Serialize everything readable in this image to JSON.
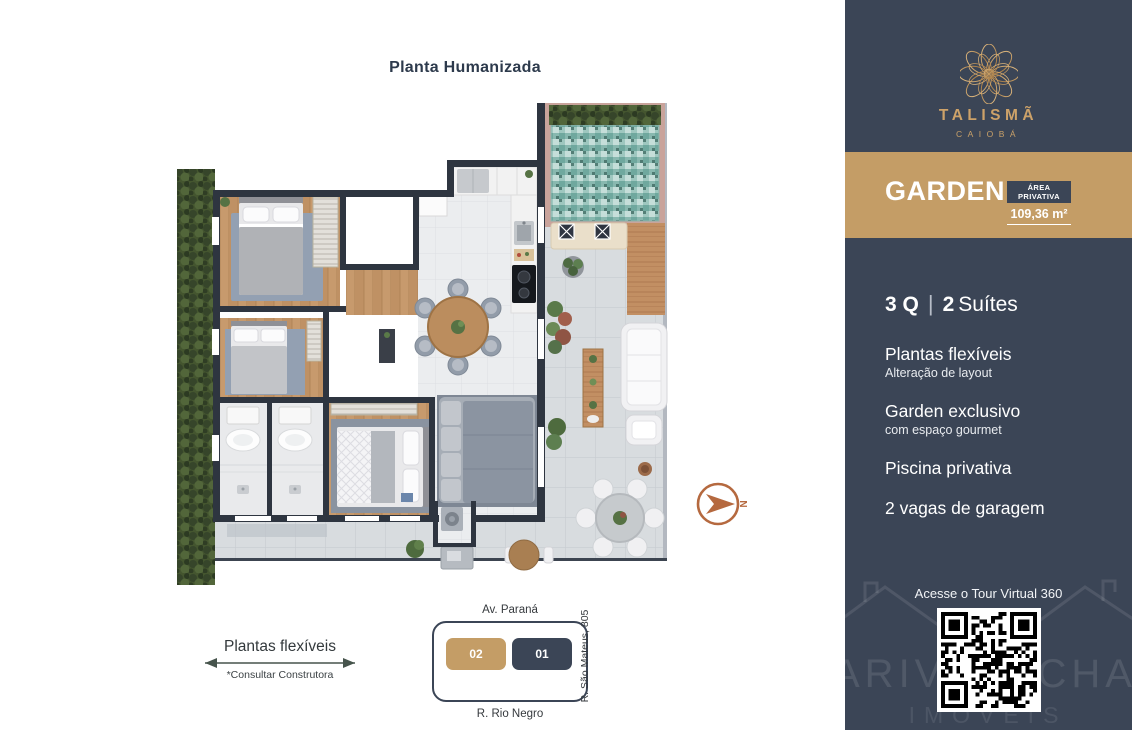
{
  "page": {
    "title": "Planta Humanizada"
  },
  "compass": {
    "north": "N"
  },
  "flex_note": {
    "label": "Plantas flexíveis",
    "note": "*Consultar Construtora"
  },
  "location": {
    "street_top": "Av. Paraná",
    "street_bottom": "R. Rio Negro",
    "street_right": "R. São Mateus, 805",
    "unit_left": "02",
    "unit_right": "01"
  },
  "sidebar": {
    "brand": {
      "name": "TALISMÃ",
      "city": "CAIOBÁ"
    },
    "banner": {
      "title": "GARDEN",
      "area_label": "ÁREA PRIVATIVA",
      "area_value": "109,36 m²"
    },
    "specs": {
      "rooms": {
        "q": "3 Q",
        "sep": "|",
        "suites_count": "2",
        "suites_label": "Suítes"
      },
      "items": [
        {
          "title": "Plantas flexíveis",
          "subtitle": "Alteração de layout"
        },
        {
          "title": "Garden exclusivo",
          "subtitle": "com espaço gourmet"
        },
        {
          "title": "Piscina privativa",
          "subtitle": ""
        },
        {
          "title": "2 vagas de garagem",
          "subtitle": ""
        }
      ]
    },
    "tour": {
      "label": "Acesse o Tour Virtual 360"
    },
    "watermark": {
      "left": "ARIVÂ",
      "right": "OCHA",
      "bottom": "IMÓVEIS"
    }
  },
  "colors": {
    "navy": "#3B4556",
    "tan": "#C49D66",
    "gold": "#CDA269",
    "compass_orange": "#B5693F",
    "wall_dark": "#2E3540",
    "pool_teal": "#7FB5AC"
  }
}
